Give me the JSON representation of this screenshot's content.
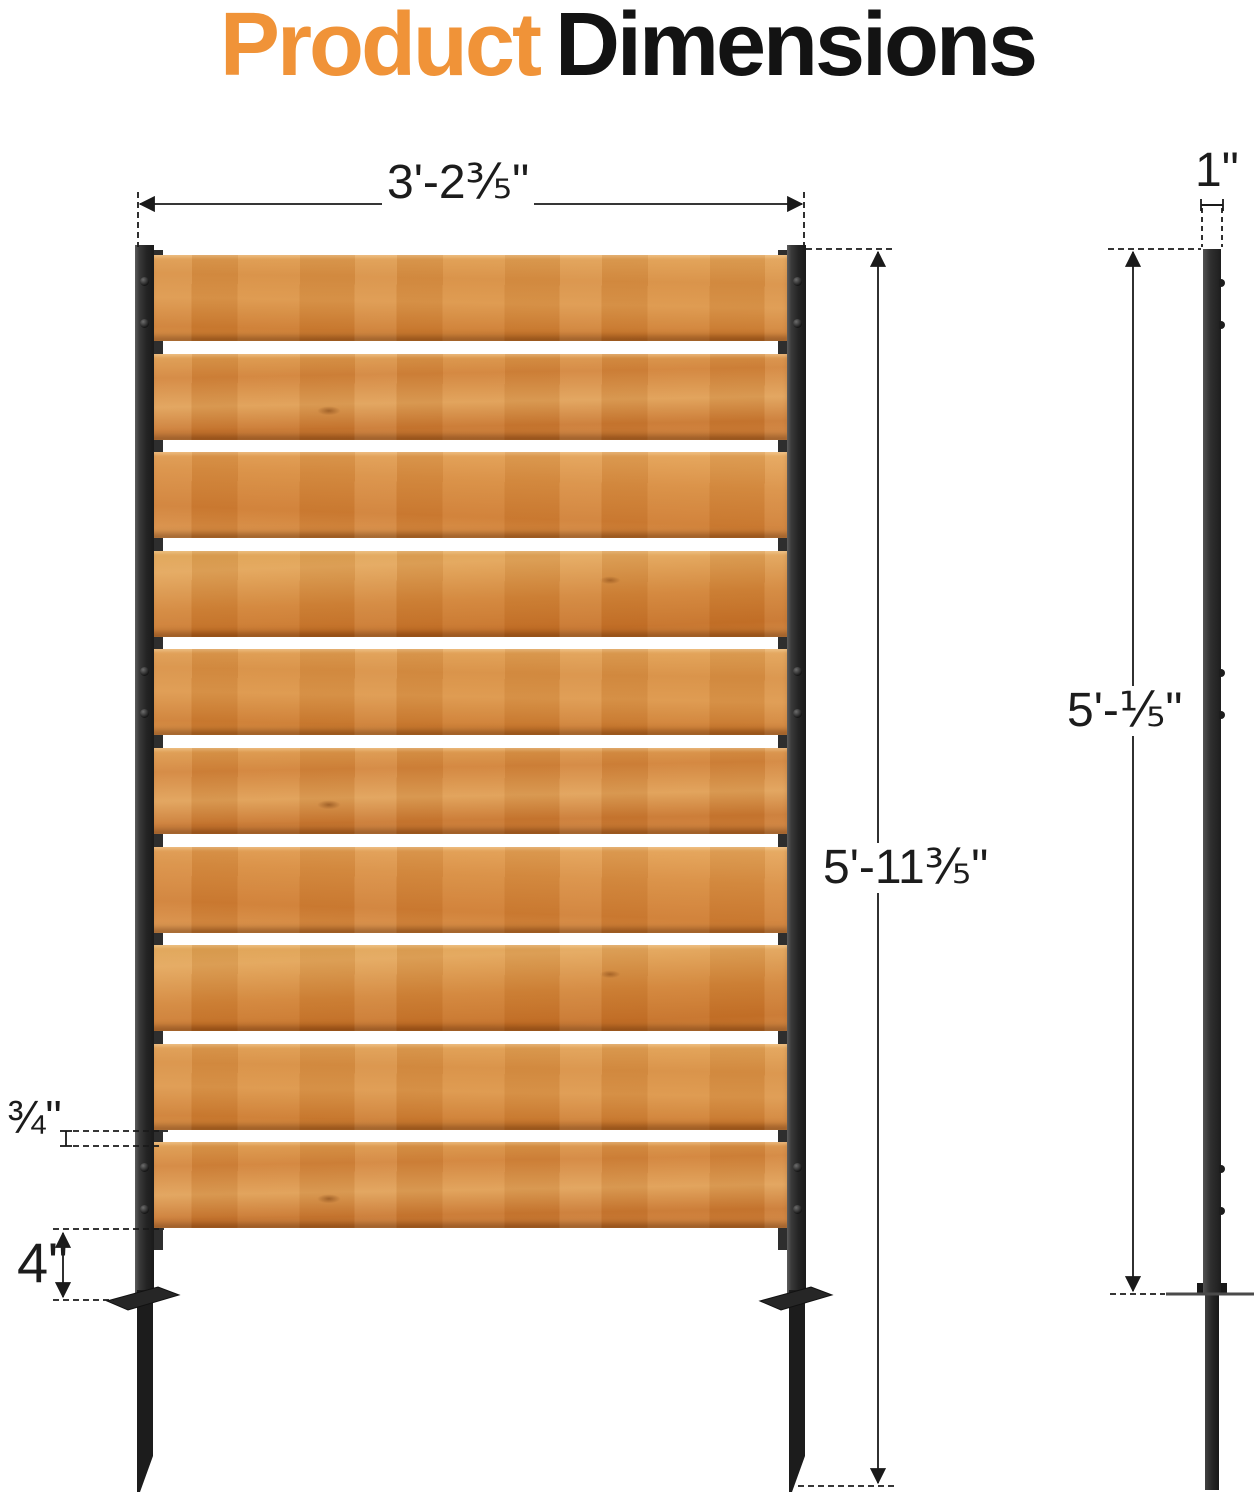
{
  "title": {
    "word_accent": "Product",
    "word_rest": "Dimensions"
  },
  "front_view": {
    "width_label": "3'-2⅗\"",
    "height_label": "5'-11⅗\"",
    "slat_gap_label": "¾\"",
    "stake_above_plate_label": "4\"",
    "slat_count": 10
  },
  "side_view": {
    "post_width_label": "1\"",
    "post_height_label": "5'-⅕\""
  },
  "colors": {
    "accent_orange": "#F09338",
    "text_black": "#131313",
    "wood_mid": "#D78E44",
    "metal_dark": "#262626"
  }
}
